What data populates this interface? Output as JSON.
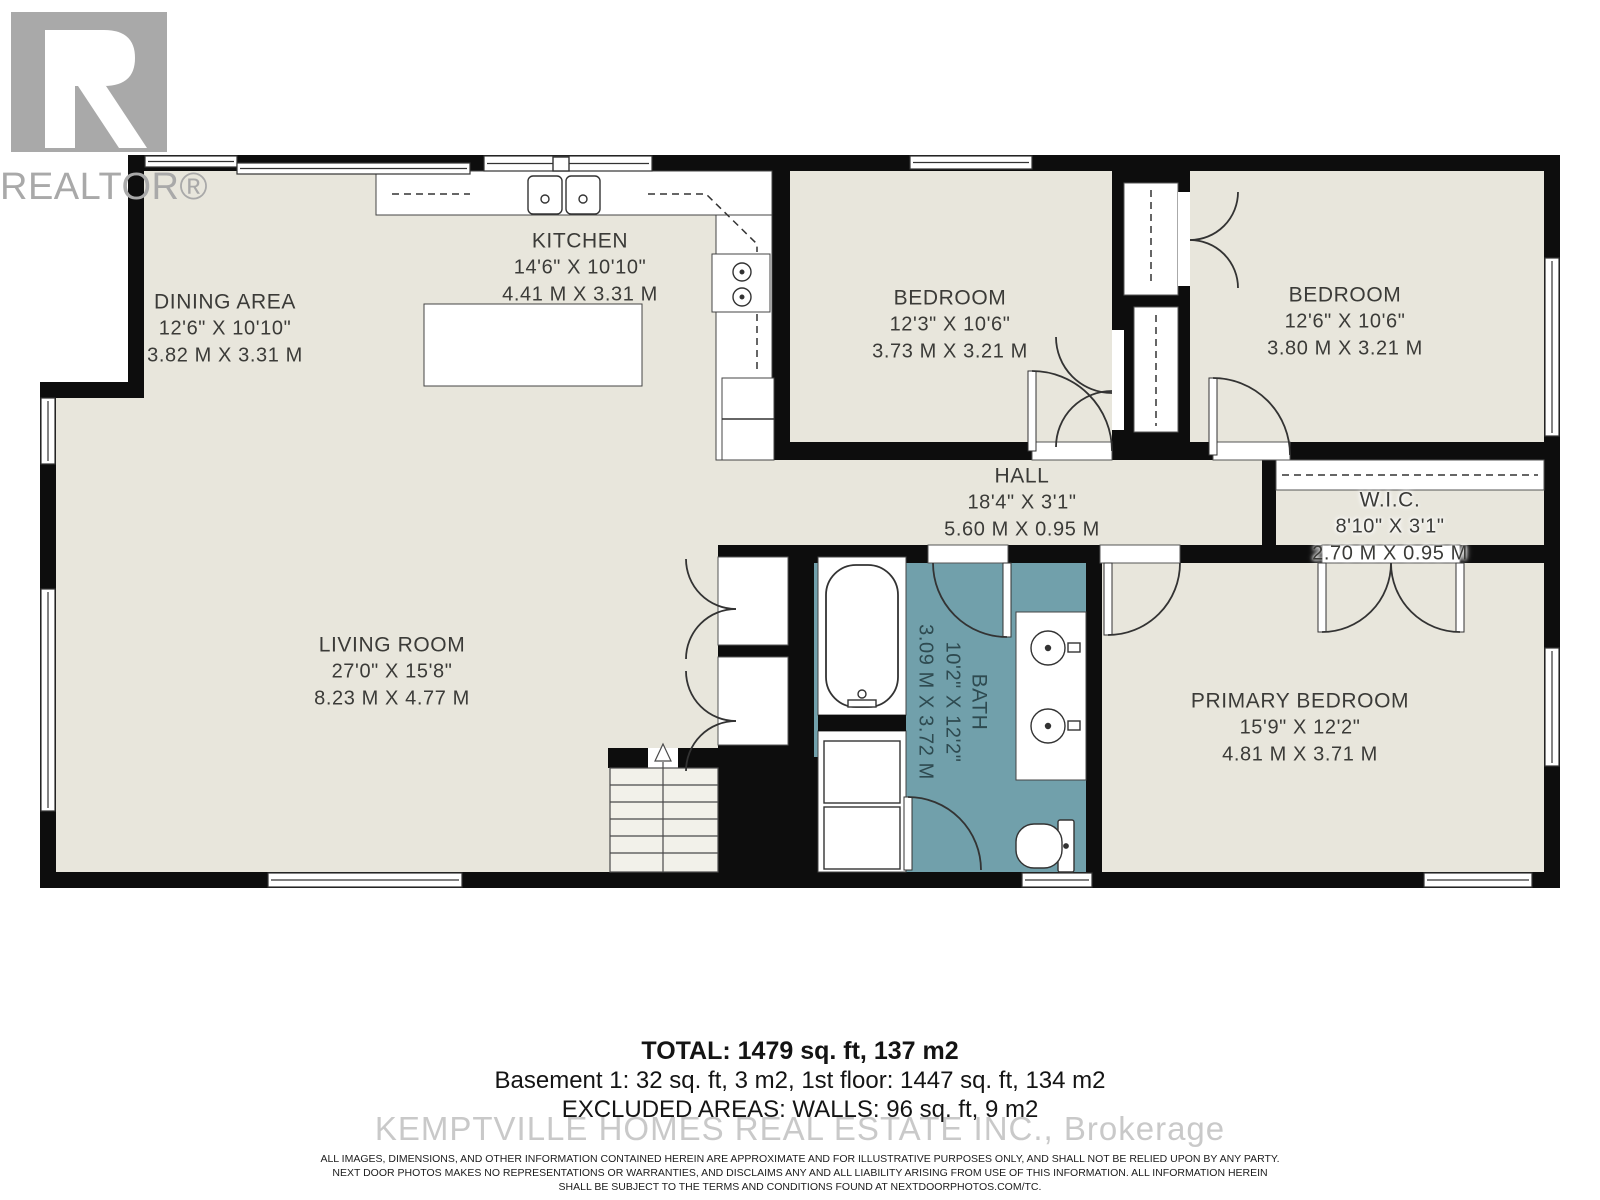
{
  "logo": {
    "brand": "REALTOR®"
  },
  "rooms": {
    "dining": {
      "name": "DINING AREA",
      "imperial": "12'6\" X 10'10\"",
      "metric": "3.82 M X 3.31 M"
    },
    "kitchen": {
      "name": "KITCHEN",
      "imperial": "14'6\" X 10'10\"",
      "metric": "4.41 M X 3.31 M"
    },
    "bedroom1": {
      "name": "BEDROOM",
      "imperial": "12'3\" X 10'6\"",
      "metric": "3.73 M X 3.21 M"
    },
    "bedroom2": {
      "name": "BEDROOM",
      "imperial": "12'6\" X 10'6\"",
      "metric": "3.80 M X 3.21 M"
    },
    "hall": {
      "name": "HALL",
      "imperial": "18'4\" X 3'1\"",
      "metric": "5.60 M X 0.95 M"
    },
    "wic": {
      "name": "W.I.C.",
      "imperial": "8'10\" X 3'1\"",
      "metric": "2.70 M X 0.95 M"
    },
    "living": {
      "name": "LIVING ROOM",
      "imperial": "27'0\" X 15'8\"",
      "metric": "8.23 M X 4.77 M"
    },
    "bath": {
      "name": "BATH",
      "imperial": "10'2\" X 12'2\"",
      "metric": "3.09 M X 3.72 M"
    },
    "primary": {
      "name": "PRIMARY BEDROOM",
      "imperial": "15'9\" X 12'2\"",
      "metric": "4.81 M X 3.71 M"
    }
  },
  "summary": {
    "total": "TOTAL: 1479 sq. ft, 137 m2",
    "breakdown": "Basement 1: 32 sq. ft, 3 m2, 1st floor: 1447 sq. ft, 134 m2",
    "excluded": "EXCLUDED AREAS: WALLS: 96 sq. ft, 9 m2"
  },
  "watermark": "KEMPTVILLE HOMES REAL ESTATE INC., Brokerage",
  "disclaimer": {
    "line1": "ALL IMAGES, DIMENSIONS, AND OTHER INFORMATION CONTAINED HEREIN ARE APPROXIMATE AND FOR ILLUSTRATIVE PURPOSES ONLY, AND SHALL NOT BE RELIED UPON BY ANY PARTY.",
    "line2": "NEXT DOOR PHOTOS MAKES NO REPRESENTATIONS OR WARRANTIES, AND DISCLAIMS ANY AND ALL LIABILITY ARISING FROM USE OF THIS INFORMATION. ALL INFORMATION HEREIN",
    "line3": "SHALL BE SUBJECT TO THE TERMS AND CONDITIONS FOUND AT NEXTDOORPHOTOS.COM/TC."
  },
  "colors": {
    "floor": "#e8e6dc",
    "bath": "#71a0ab",
    "wall": "#0d0d0d",
    "logo_gray": "#a9a9a9",
    "watermark_gray": "#c7c7c7"
  }
}
